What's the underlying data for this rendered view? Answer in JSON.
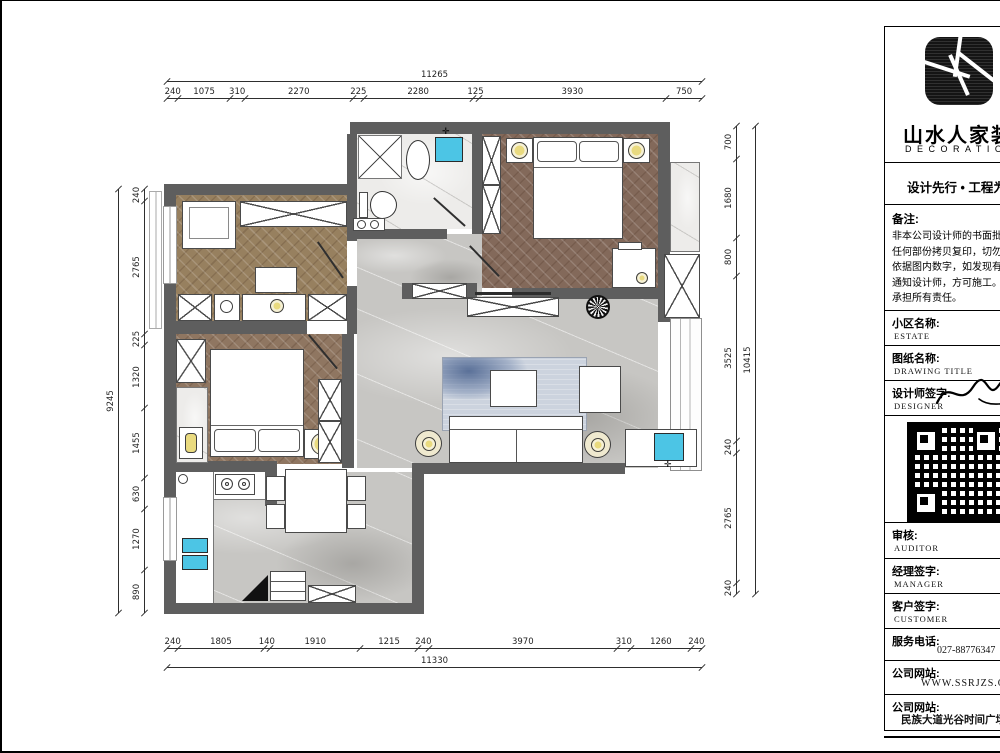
{
  "title_block": {
    "brand": {
      "name": "山水人家装饰",
      "sub": "DECORATION"
    },
    "slogan": {
      "text": "设计先行  •  工程为本"
    },
    "notes": {
      "label": "备注:",
      "lines": [
        "  非本公司设计师的书面批准，不得将",
        "任何部份拷贝复印，切勿比例量度，",
        "依据图内数字，如发现有任何矛盾，",
        "通知设计师，方可施工。否则施工方",
        "承担所有责任。"
      ]
    },
    "rows": [
      {
        "label": "小区名称:",
        "sub": "ESTATE"
      },
      {
        "label": "图纸名称:",
        "sub": "DRAWING TITLE"
      },
      {
        "label": "设计师签字:",
        "sub": "DESIGNER"
      },
      {
        "label": "审核:",
        "sub": "AUDITOR"
      },
      {
        "label": "经理签字:",
        "sub": "MANAGER"
      },
      {
        "label": "客户签字:",
        "sub": "CUSTOMER"
      },
      {
        "label": "服务电话:",
        "value": "027-88776347"
      },
      {
        "label": "公司网站:",
        "value": "WWW.SSRJZS.COM"
      },
      {
        "label": "公司网站:",
        "value": "民族大道光谷时间广场16楼"
      }
    ]
  },
  "dimensions": {
    "top": {
      "total": "11265",
      "segments": [
        "240",
        "1075",
        "310",
        "2270",
        "225",
        "2280",
        "125",
        "3930",
        "750"
      ]
    },
    "bottom": {
      "total": "11330",
      "segments": [
        "240",
        "1805",
        "140",
        "1910",
        "1215",
        "240",
        "3970",
        "310",
        "1260",
        "240"
      ]
    },
    "left": {
      "total": "9245",
      "segments": [
        "240",
        "2765",
        "225",
        "1320",
        "1455",
        "630",
        "1270",
        "890"
      ]
    },
    "right": {
      "total": "10415",
      "segments": [
        "700",
        "1680",
        "800",
        "3525",
        "240",
        "2765",
        "240"
      ]
    }
  },
  "colors": {
    "wall": "#5e5e5e",
    "wood": "#8f7661",
    "wood_dark": "#83695a",
    "marble": "#c7c6c3",
    "marble_light": "#edecea",
    "lamp_yellow": "#e9da7f",
    "sink_cyan": "#4cc5e5",
    "rug_blue": "#ccd3de"
  }
}
